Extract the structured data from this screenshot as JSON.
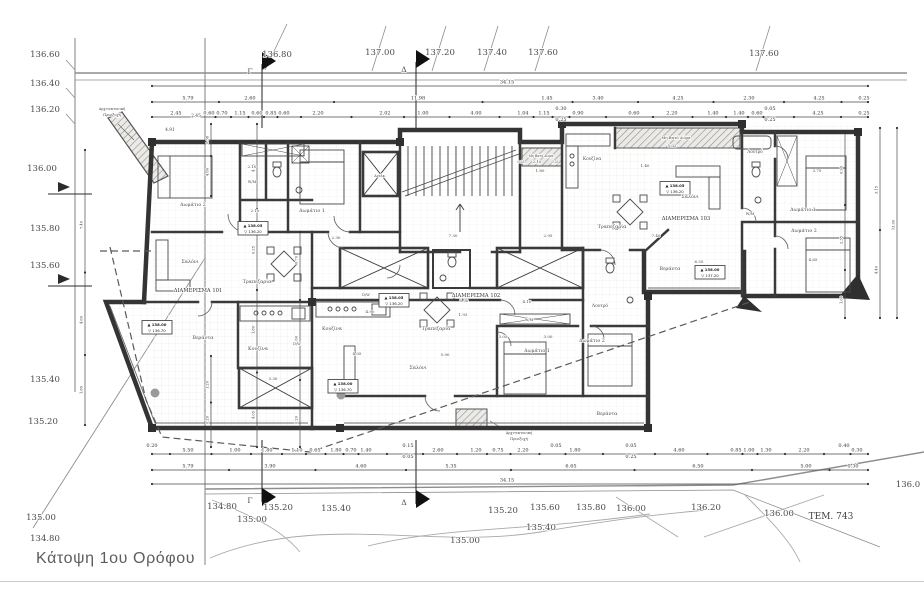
{
  "meta": {
    "title": "Κάτοψη 1ου Ορόφου"
  },
  "labels": [
    {
      "n": "contour-label",
      "x": 45,
      "y": 57,
      "t": "136.60",
      "s": 8.5
    },
    {
      "n": "contour-label",
      "x": 45,
      "y": 86,
      "t": "136.40",
      "s": 8.5
    },
    {
      "n": "contour-label",
      "x": 45,
      "y": 112,
      "t": "136.20",
      "s": 8.5
    },
    {
      "n": "contour-label",
      "x": 42,
      "y": 171,
      "t": "136.00",
      "s": 8.5
    },
    {
      "n": "contour-label",
      "x": 45,
      "y": 231,
      "t": "135.80",
      "s": 8.5
    },
    {
      "n": "contour-label",
      "x": 45,
      "y": 268,
      "t": "135.60",
      "s": 8.5
    },
    {
      "n": "contour-label",
      "x": 45,
      "y": 382,
      "t": "135.40",
      "s": 8.5
    },
    {
      "n": "contour-label",
      "x": 43,
      "y": 424,
      "t": "135.20",
      "s": 8.5
    },
    {
      "n": "contour-label",
      "x": 41,
      "y": 520,
      "t": "135.00",
      "s": 8.5
    },
    {
      "n": "contour-label",
      "x": 45,
      "y": 541,
      "t": "134.80",
      "s": 8.5
    },
    {
      "n": "contour-label",
      "x": 277,
      "y": 57,
      "t": "136.80",
      "s": 8.5
    },
    {
      "n": "contour-label",
      "x": 380,
      "y": 55,
      "t": "137.00",
      "s": 8.5
    },
    {
      "n": "contour-label",
      "x": 440,
      "y": 55,
      "t": "137.20",
      "s": 8.5
    },
    {
      "n": "contour-label",
      "x": 492,
      "y": 55,
      "t": "137.40",
      "s": 8.5
    },
    {
      "n": "contour-label",
      "x": 543,
      "y": 55,
      "t": "137.60",
      "s": 8.5
    },
    {
      "n": "contour-label",
      "x": 764,
      "y": 56,
      "t": "137.60",
      "s": 8.5
    },
    {
      "n": "contour-label",
      "x": 222,
      "y": 509,
      "t": "134.80",
      "s": 8.5
    },
    {
      "n": "contour-label",
      "x": 278,
      "y": 510,
      "t": "135.20",
      "s": 8.5
    },
    {
      "n": "contour-label",
      "x": 336,
      "y": 511,
      "t": "135.40",
      "s": 8.5
    },
    {
      "n": "contour-label",
      "x": 252,
      "y": 522,
      "t": "135.00",
      "s": 8.5
    },
    {
      "n": "contour-label",
      "x": 503,
      "y": 513,
      "t": "135.20",
      "s": 8.5
    },
    {
      "n": "contour-label",
      "x": 545,
      "y": 510,
      "t": "135.60",
      "s": 8.5
    },
    {
      "n": "contour-label",
      "x": 591,
      "y": 510,
      "t": "135.80",
      "s": 8.5
    },
    {
      "n": "contour-label",
      "x": 541,
      "y": 530,
      "t": "135.40",
      "s": 8.5
    },
    {
      "n": "contour-label",
      "x": 465,
      "y": 543,
      "t": "135.00",
      "s": 8.5
    },
    {
      "n": "contour-label",
      "x": 631,
      "y": 511,
      "t": "136.00",
      "s": 8.5
    },
    {
      "n": "contour-label",
      "x": 706,
      "y": 510,
      "t": "136.20",
      "s": 8.5
    },
    {
      "n": "contour-label",
      "x": 779,
      "y": 516,
      "t": "136.00",
      "s": 8.5
    },
    {
      "n": "contour-label",
      "x": 908,
      "y": 487,
      "t": "136.0",
      "s": 8.5
    },
    {
      "n": "parcel-label",
      "x": 831,
      "y": 519,
      "t": "ΤΕΜ. 743",
      "s": 9,
      "c": "#3f3f3f"
    },
    {
      "n": "section-flag-letter",
      "x": 250,
      "y": 74,
      "t": "Γ",
      "s": 7.5
    },
    {
      "n": "section-flag-letter",
      "x": 404,
      "y": 72,
      "t": "Δ",
      "s": 7.5
    },
    {
      "n": "section-flag-letter",
      "x": 250,
      "y": 503,
      "t": "Γ",
      "s": 7.5
    },
    {
      "n": "section-flag-letter",
      "x": 404,
      "y": 505,
      "t": "Δ",
      "s": 7.5
    },
    {
      "n": "apartment-label",
      "x": 198,
      "y": 292,
      "t": "ΔΙΑΜΕΡΙΣΜΑ 101",
      "s": 5.2,
      "c": "#333"
    },
    {
      "n": "apartment-label",
      "x": 476,
      "y": 297,
      "t": "ΔΙΑΜΕΡΙΣΜΑ 102",
      "s": 5.2,
      "c": "#333"
    },
    {
      "n": "apartment-label",
      "x": 686,
      "y": 220,
      "t": "ΔΙΑΜΕΡΙΣΜΑ 103",
      "s": 5.2,
      "c": "#333"
    },
    {
      "n": "room-label",
      "x": 193,
      "y": 206,
      "t": "Δωμάτιο 2",
      "s": 4.8
    },
    {
      "n": "room-label",
      "x": 312,
      "y": 212,
      "t": "Δωμάτιο 1",
      "s": 4.8
    },
    {
      "n": "room-label",
      "x": 190,
      "y": 263,
      "t": "Σαλόνι",
      "s": 4.8
    },
    {
      "n": "room-label",
      "x": 257,
      "y": 283,
      "t": "Τραπεζαρία",
      "s": 4.8
    },
    {
      "n": "room-label",
      "x": 258,
      "y": 350,
      "t": "Κουζίνα",
      "s": 4.8
    },
    {
      "n": "room-label",
      "x": 297,
      "y": 345,
      "t": "D/W",
      "s": 3.6
    },
    {
      "n": "room-label",
      "x": 203,
      "y": 339,
      "t": "Βεράντα",
      "s": 4.8
    },
    {
      "n": "room-label",
      "x": 252,
      "y": 183,
      "t": "W/M",
      "s": 3.6
    },
    {
      "n": "room-label",
      "x": 332,
      "y": 330,
      "t": "Κουζίνα",
      "s": 4.8
    },
    {
      "n": "room-label",
      "x": 366,
      "y": 296,
      "t": "D/W",
      "s": 3.6
    },
    {
      "n": "room-label",
      "x": 436,
      "y": 330,
      "t": "Τραπεζαρία",
      "s": 4.8
    },
    {
      "n": "room-label",
      "x": 418,
      "y": 369,
      "t": "Σαλόνι",
      "s": 4.8
    },
    {
      "n": "room-label",
      "x": 537,
      "y": 352,
      "t": "Δωμάτιο 1",
      "s": 4.8
    },
    {
      "n": "room-label",
      "x": 592,
      "y": 342,
      "t": "Δωμάτιο 2",
      "s": 4.8
    },
    {
      "n": "room-label",
      "x": 600,
      "y": 307,
      "t": "Λουτρό",
      "s": 4.4
    },
    {
      "n": "room-label",
      "x": 529,
      "y": 321,
      "t": "W/M",
      "s": 3.6
    },
    {
      "n": "room-label",
      "x": 607,
      "y": 415,
      "t": "Βεράντα",
      "s": 4.8
    },
    {
      "n": "room-label",
      "x": 592,
      "y": 160,
      "t": "Κουζίνα",
      "s": 4.4
    },
    {
      "n": "room-label",
      "x": 676,
      "y": 139,
      "t": "Μη Βατό Δώμα",
      "s": 3.8
    },
    {
      "n": "room-label",
      "x": 541,
      "y": 157,
      "t": "Μη Βατό Δώμα",
      "s": 3.2
    },
    {
      "n": "room-label",
      "x": 755,
      "y": 153,
      "t": "Λουτρό",
      "s": 4.2
    },
    {
      "n": "room-label",
      "x": 750,
      "y": 215,
      "t": "W/M",
      "s": 3.6
    },
    {
      "n": "room-label",
      "x": 690,
      "y": 198,
      "t": "Σαλόνι",
      "s": 4.8
    },
    {
      "n": "room-label",
      "x": 612,
      "y": 228,
      "t": "Τραπεζαρία",
      "s": 4.8
    },
    {
      "n": "room-label",
      "x": 803,
      "y": 211,
      "t": "Δωμάτιο 1",
      "s": 4.8
    },
    {
      "n": "room-label",
      "x": 804,
      "y": 232,
      "t": "Δωμάτιο 2",
      "s": 4.8
    },
    {
      "n": "room-label",
      "x": 670,
      "y": 270,
      "t": "Βεράντα",
      "s": 4.8
    },
    {
      "n": "room-label",
      "x": 380,
      "y": 177,
      "t": "Ανελκ.",
      "s": 3.4
    },
    {
      "n": "note-label",
      "x": 112,
      "y": 110,
      "t": "Αρχιτεκτονική",
      "s": 3.6
    },
    {
      "n": "note-label",
      "x": 112,
      "y": 116,
      "t": "Προεξοχή",
      "s": 3.6
    },
    {
      "n": "note-label",
      "x": 519,
      "y": 434,
      "t": "Αρχιτεκτονική",
      "s": 3.6
    },
    {
      "n": "note-label",
      "x": 519,
      "y": 440,
      "t": "Προεξοχή",
      "s": 3.6
    },
    {
      "n": "plan-dim-label",
      "x": 252,
      "y": 168,
      "t": "2.10",
      "s": 4
    },
    {
      "n": "plan-dim-label",
      "x": 255,
      "y": 212,
      "t": "2.10",
      "s": 4
    },
    {
      "n": "plan-dim-label",
      "x": 336,
      "y": 239,
      "t": "2.30",
      "s": 4
    },
    {
      "n": "plan-dim-label",
      "x": 453,
      "y": 237,
      "t": "7.30",
      "s": 4
    },
    {
      "n": "plan-dim-label",
      "x": 548,
      "y": 237,
      "t": "2.95",
      "s": 4
    },
    {
      "n": "plan-dim-label",
      "x": 537,
      "y": 163,
      "t": "2.10",
      "s": 4
    },
    {
      "n": "plan-dim-label",
      "x": 521,
      "y": 163,
      "t": "0.25",
      "s": 3.2
    },
    {
      "n": "plan-dim-label",
      "x": 555,
      "y": 163,
      "t": "0.25",
      "s": 3.2
    },
    {
      "n": "plan-dim-label",
      "x": 540,
      "y": 172,
      "t": "1.80",
      "s": 4
    },
    {
      "n": "plan-dim-label",
      "x": 672,
      "y": 147,
      "t": "5.02",
      "s": 4
    },
    {
      "n": "plan-dim-label",
      "x": 645,
      "y": 167,
      "t": "1.40",
      "s": 4
    },
    {
      "n": "plan-dim-label",
      "x": 656,
      "y": 237,
      "t": "7.40",
      "s": 4
    },
    {
      "n": "plan-dim-label",
      "x": 699,
      "y": 263,
      "t": "6.55",
      "s": 4
    },
    {
      "n": "plan-dim-label",
      "x": 813,
      "y": 261,
      "t": "4.65",
      "s": 4
    },
    {
      "n": "plan-dim-label",
      "x": 527,
      "y": 303,
      "t": "4.10",
      "s": 4
    },
    {
      "n": "plan-dim-label",
      "x": 463,
      "y": 316,
      "t": "1.93",
      "s": 4
    },
    {
      "n": "plan-dim-label",
      "x": 548,
      "y": 338,
      "t": "3.00",
      "s": 4
    },
    {
      "n": "plan-dim-label",
      "x": 503,
      "y": 338,
      "t": "3.05",
      "s": 4
    },
    {
      "n": "plan-dim-label",
      "x": 357,
      "y": 355,
      "t": "4.05",
      "s": 4
    },
    {
      "n": "plan-dim-label",
      "x": 445,
      "y": 356,
      "t": "5.90",
      "s": 4
    },
    {
      "n": "plan-dim-label",
      "x": 370,
      "y": 313,
      "t": "4.90",
      "s": 4
    },
    {
      "n": "plan-dim-label",
      "x": 464,
      "y": 302,
      "t": "5.00",
      "s": 4
    },
    {
      "n": "plan-dim-label",
      "x": 817,
      "y": 172,
      "t": "3.75",
      "s": 4
    },
    {
      "n": "plan-dim-label",
      "x": 273,
      "y": 380,
      "t": "3.30",
      "s": 4
    },
    {
      "n": "plan-dim-label",
      "x": 170,
      "y": 131,
      "t": "4.91",
      "s": 4.4
    },
    {
      "n": "plan-dim-label",
      "x": 196,
      "y": 117,
      "t": "2.45",
      "s": 4.4
    }
  ],
  "dim_rows": [
    {
      "name": "top-dim-overall",
      "y": 84,
      "x1": 152,
      "x2": 868,
      "labels": [
        {
          "x": 507,
          "t": "34.15"
        }
      ]
    },
    {
      "name": "top-dim-row-2",
      "y": 100,
      "x1": 152,
      "x2": 868,
      "labels": [
        {
          "x": 188,
          "t": "5.79"
        },
        {
          "x": 250,
          "t": "2.60"
        },
        {
          "x": 418,
          "t": "11.98"
        },
        {
          "x": 547,
          "t": "1.45"
        },
        {
          "x": 598,
          "t": "3.40"
        },
        {
          "x": 678,
          "t": "4.25"
        },
        {
          "x": 749,
          "t": "2.30"
        },
        {
          "x": 819,
          "t": "4.25"
        },
        {
          "x": 864,
          "t": "0.25"
        }
      ]
    },
    {
      "name": "top-dim-row-3",
      "y": 115,
      "x1": 152,
      "x2": 868,
      "labels": [
        {
          "x": 176,
          "t": "2.45"
        },
        {
          "x": 209,
          "t": "0.60"
        },
        {
          "x": 222,
          "t": "0.70"
        },
        {
          "x": 240,
          "t": "1.15"
        },
        {
          "x": 257,
          "t": "0.60"
        },
        {
          "x": 271,
          "t": "0.85"
        },
        {
          "x": 284,
          "t": "0.60"
        },
        {
          "x": 318,
          "t": "2.20"
        },
        {
          "x": 385,
          "t": "2.02"
        },
        {
          "x": 423,
          "t": "1.00"
        },
        {
          "x": 476,
          "t": "4.00"
        },
        {
          "x": 523,
          "t": "1.04"
        },
        {
          "x": 544,
          "t": "1.15"
        },
        {
          "x": 561,
          "t": "0.30",
          "dy": -6
        },
        {
          "x": 561,
          "t": "0.25",
          "dy": 5
        },
        {
          "x": 578,
          "t": "0.90"
        },
        {
          "x": 634,
          "t": "0.60"
        },
        {
          "x": 672,
          "t": "2.20"
        },
        {
          "x": 713,
          "t": "1.40"
        },
        {
          "x": 739,
          "t": "1.40"
        },
        {
          "x": 757,
          "t": "0.60"
        },
        {
          "x": 770,
          "t": "0.05",
          "dy": -6
        },
        {
          "x": 770,
          "t": "0.25",
          "dy": 5
        },
        {
          "x": 818,
          "t": "4.25"
        },
        {
          "x": 864,
          "t": "0.25"
        }
      ]
    },
    {
      "name": "bottom-dim-row-1",
      "y": 452,
      "x1": 152,
      "x2": 868,
      "labels": [
        {
          "x": 152,
          "t": "0.20",
          "dy": -6
        },
        {
          "x": 188,
          "t": "5.50"
        },
        {
          "x": 235,
          "t": "1.00"
        },
        {
          "x": 267,
          "t": "1.80"
        },
        {
          "x": 297,
          "t": "1.10"
        },
        {
          "x": 315,
          "t": "0.65"
        },
        {
          "x": 336,
          "t": "1.80"
        },
        {
          "x": 351,
          "t": "0.70"
        },
        {
          "x": 366,
          "t": "1.40"
        },
        {
          "x": 408,
          "t": "0.15",
          "dy": -6
        },
        {
          "x": 408,
          "t": "0.05",
          "dy": 5
        },
        {
          "x": 438,
          "t": "2.60"
        },
        {
          "x": 476,
          "t": "1.20"
        },
        {
          "x": 498,
          "t": "0.75"
        },
        {
          "x": 523,
          "t": "2.20"
        },
        {
          "x": 556,
          "t": "0.05",
          "dy": -6
        },
        {
          "x": 575,
          "t": "1.80"
        },
        {
          "x": 631,
          "t": "0.05",
          "dy": -6
        },
        {
          "x": 631,
          "t": "0.25",
          "dy": 5
        },
        {
          "x": 679,
          "t": "4.60"
        },
        {
          "x": 736,
          "t": "0.85"
        },
        {
          "x": 749,
          "t": "1.00"
        },
        {
          "x": 766,
          "t": "1.30"
        },
        {
          "x": 804,
          "t": "2.20"
        },
        {
          "x": 844,
          "t": "0.40",
          "dy": -6
        },
        {
          "x": 857,
          "t": "0.30"
        }
      ]
    },
    {
      "name": "bottom-dim-row-2",
      "y": 468,
      "x1": 152,
      "x2": 868,
      "labels": [
        {
          "x": 188,
          "t": "5.79"
        },
        {
          "x": 270,
          "t": "3.90"
        },
        {
          "x": 361,
          "t": "4.60"
        },
        {
          "x": 451,
          "t": "5.35"
        },
        {
          "x": 571,
          "t": "6.65"
        },
        {
          "x": 698,
          "t": "6.50"
        },
        {
          "x": 806,
          "t": "5.00"
        },
        {
          "x": 853,
          "t": "0.30"
        }
      ]
    },
    {
      "name": "bottom-dim-overall",
      "y": 482,
      "x1": 152,
      "x2": 868,
      "labels": [
        {
          "x": 507,
          "t": "34.15"
        }
      ]
    }
  ],
  "vdim_rows": [
    {
      "name": "vdim-left-site",
      "x": 85,
      "y1": 150,
      "y2": 425,
      "labels": [
        {
          "y": 225,
          "t": "7.40"
        },
        {
          "y": 320,
          "t": "4.60"
        },
        {
          "y": 390,
          "t": "1.80"
        }
      ]
    },
    {
      "name": "vdim-left-a",
      "x": 211,
      "y1": 124,
      "y2": 196,
      "labels": [
        {
          "y": 140,
          "t": "0.38"
        },
        {
          "y": 172,
          "t": "4.60"
        }
      ]
    },
    {
      "name": "vdim-left-b",
      "x": 211,
      "y1": 356,
      "y2": 447,
      "labels": [
        {
          "y": 385,
          "t": "1.20"
        },
        {
          "y": 420,
          "t": "0.20"
        }
      ]
    },
    {
      "name": "vdim-left-c",
      "x": 257,
      "y1": 124,
      "y2": 447,
      "labels": [
        {
          "y": 168,
          "t": "4.60"
        },
        {
          "y": 250,
          "t": "0.25"
        },
        {
          "y": 330,
          "t": "1.80"
        },
        {
          "y": 415,
          "t": "4.05"
        }
      ]
    },
    {
      "name": "vdim-left-d",
      "x": 300,
      "y1": 232,
      "y2": 447,
      "labels": [
        {
          "y": 260,
          "t": "0.70"
        },
        {
          "y": 340,
          "t": "1.60"
        },
        {
          "y": 420,
          "t": "0.20"
        }
      ]
    },
    {
      "name": "vdim-right-a",
      "x": 845,
      "y1": 132,
      "y2": 318,
      "labels": [
        {
          "y": 170,
          "t": "0.90"
        },
        {
          "y": 240,
          "t": "2.35"
        },
        {
          "y": 300,
          "t": "1.00"
        }
      ]
    },
    {
      "name": "vdim-right-b",
      "x": 880,
      "y1": 128,
      "y2": 318,
      "labels": [
        {
          "y": 190,
          "t": "3.15"
        },
        {
          "y": 270,
          "t": "4.40"
        }
      ]
    },
    {
      "name": "vdim-right-c",
      "x": 897,
      "y1": 128,
      "y2": 318,
      "labels": [
        {
          "y": 225,
          "t": "13.90"
        }
      ]
    }
  ],
  "level_marks": [
    {
      "x": 253,
      "y": 228,
      "up": "138.05",
      "down": "136.20"
    },
    {
      "x": 157,
      "y": 327,
      "up": "138.00",
      "down": "136.70"
    },
    {
      "x": 394,
      "y": 300,
      "up": "138.05",
      "down": "136.20"
    },
    {
      "x": 343,
      "y": 386,
      "up": "138.00",
      "down": "136.70"
    },
    {
      "x": 675,
      "y": 188,
      "up": "138.05",
      "down": "136.20"
    },
    {
      "x": 710,
      "y": 272,
      "up": "138.00",
      "down": "137.20"
    }
  ]
}
